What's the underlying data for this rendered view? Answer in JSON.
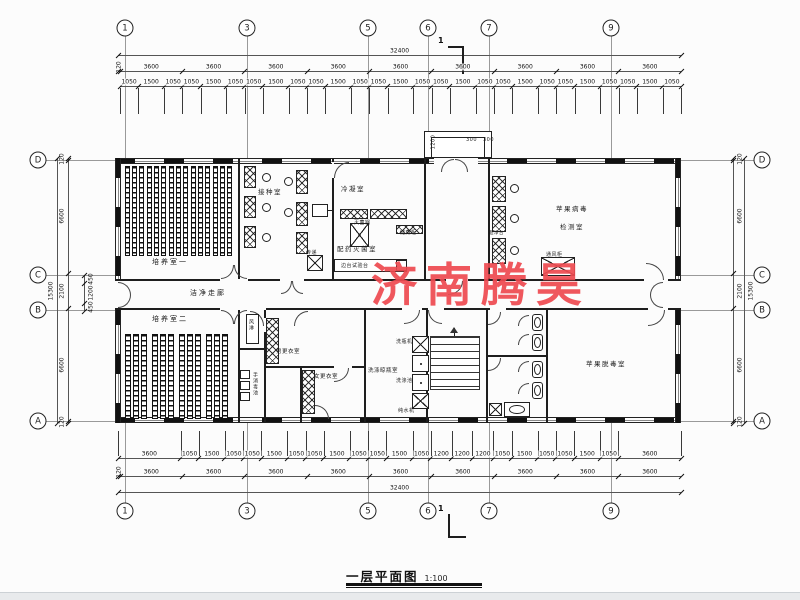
{
  "watermark": {
    "text": "济南腾昊",
    "color": "#ee4a50"
  },
  "title": {
    "text": "一层平面图",
    "scale": "1:100"
  },
  "section_mark": {
    "label": "1"
  },
  "grid": {
    "top": [
      "1",
      "3",
      "5",
      "6",
      "7",
      "9"
    ],
    "bottom": [
      "1",
      "3",
      "5",
      "6",
      "7",
      "9"
    ],
    "left": [
      "D",
      "C",
      "B",
      "A"
    ],
    "right": [
      "D",
      "C",
      "B",
      "A"
    ]
  },
  "dims": {
    "top_total": [
      32400
    ],
    "top_major": [
      120,
      3600,
      3600,
      3600,
      3600,
      3600,
      3600,
      3600,
      3600,
      3600
    ],
    "top_minor": [
      1050,
      1500,
      1050,
      1050,
      1500,
      1050,
      1050,
      1500,
      1050,
      1050,
      1500,
      1050,
      1050,
      1500,
      1050,
      1050,
      1500,
      1050,
      1050,
      1500,
      1050,
      1050,
      1500,
      1050,
      1050,
      1500,
      1050
    ],
    "bottom_minor": [
      3600,
      1050,
      1500,
      1050,
      1050,
      1500,
      1050,
      1050,
      1500,
      1050,
      1050,
      1500,
      1050,
      1200,
      1200,
      1200,
      1050,
      1500,
      1050,
      1050,
      1500,
      1050,
      3600
    ],
    "bottom_major": [
      120,
      3600,
      3600,
      3600,
      3600,
      3600,
      3600,
      3600,
      3600,
      3600
    ],
    "bottom_total": [
      32400
    ],
    "left_major": [
      120,
      6600,
      2100,
      6600,
      120
    ],
    "left_minor": [
      450,
      1200,
      450
    ],
    "left_total": [
      15300
    ],
    "right_major": [
      120,
      6600,
      2100,
      6600,
      120
    ],
    "right_total": [
      15300
    ],
    "entrance_depth": "1200",
    "entrance_a": "300",
    "entrance_b": "300"
  },
  "rooms": {
    "culture1": "培养室一",
    "inoculation": "接种室",
    "condensation": "冷凝室",
    "prep_steril": "配药灭菌室",
    "virus_test_line1": "苹果病毒",
    "virus_test_line2": "检测室",
    "corridor": "洁净走廊",
    "culture2": "培养室二",
    "men_change": "男更衣室",
    "women_change": "女更衣室",
    "washing": "洗涤晾瓶室",
    "detox": "苹果脱毒室",
    "air_shower": "风淋",
    "hand_wash": "手消毒池"
  },
  "equipment": {
    "sterilizer": "灭菌锅",
    "storage": "储藏柜",
    "side_bench": "边台试验台",
    "pass_window": "传递",
    "clean_bench": "超净台",
    "fume_hood": "通风柜",
    "bottle_washer": "洗瓶机",
    "wash_sink": "洗涤池",
    "water_machine": "纯水机"
  }
}
